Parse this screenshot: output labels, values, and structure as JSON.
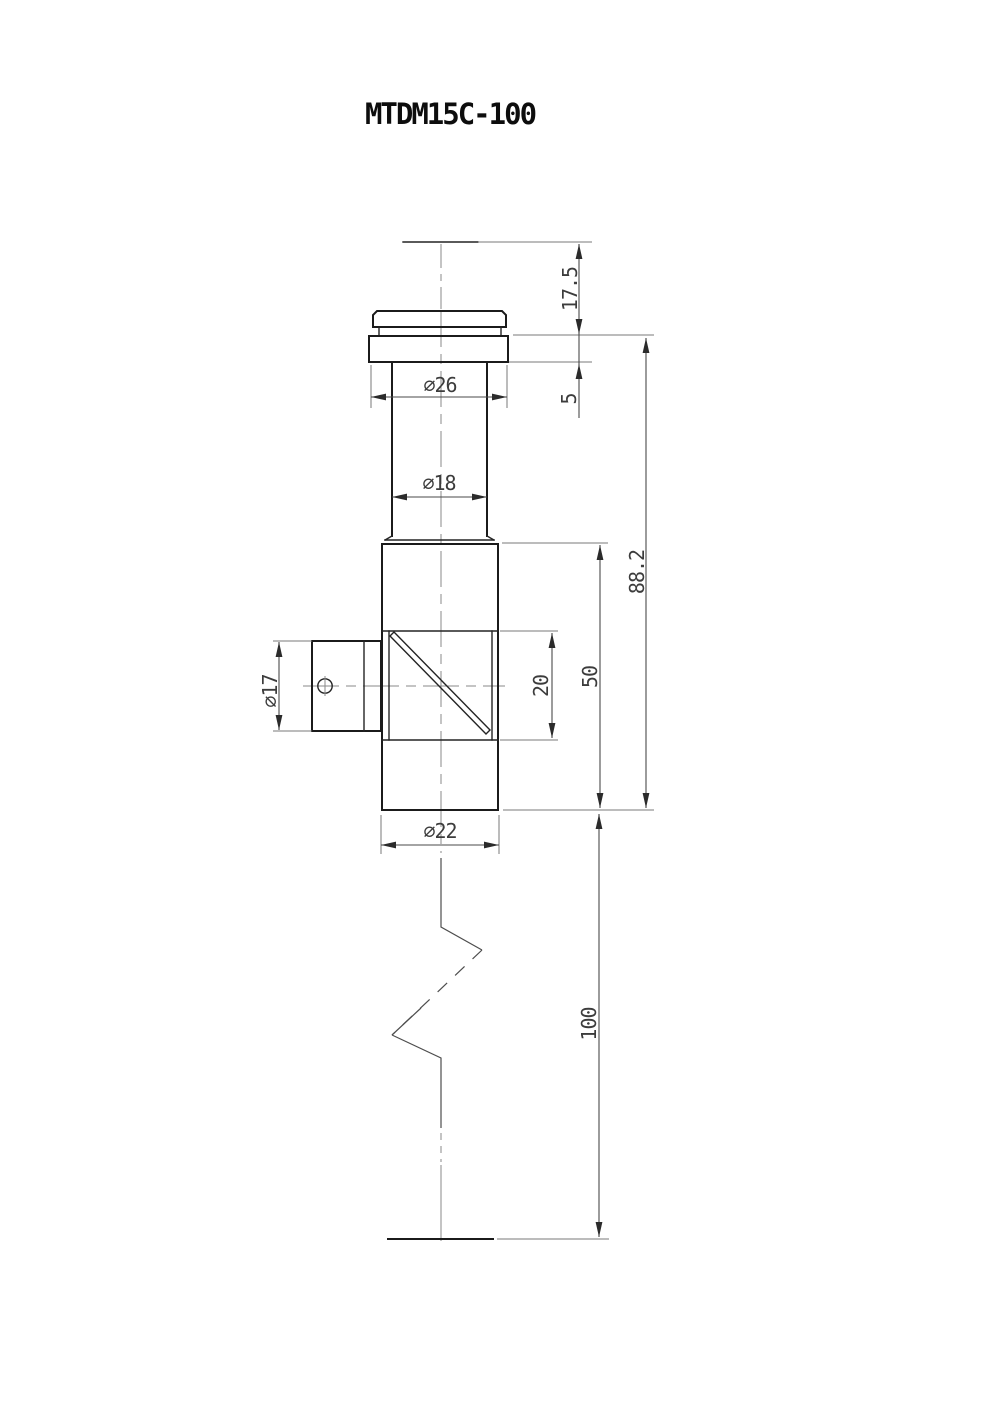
{
  "title": "MTDM15C-100",
  "drawing": {
    "kind": "dimensioned engineering drawing, front view with partial break",
    "part_number": "MTDM15C-100"
  },
  "dimensions": {
    "head_height": "17.5",
    "flange_thickness": "5",
    "flange_diameter": "⌀26",
    "upper_tube_diameter": "⌀18",
    "height_below_flange": "88.2",
    "body_height": "50",
    "prism_window_height": "20",
    "side_port_diameter": "⌀17",
    "body_diameter": "⌀22",
    "lower_tube_length": "100"
  }
}
